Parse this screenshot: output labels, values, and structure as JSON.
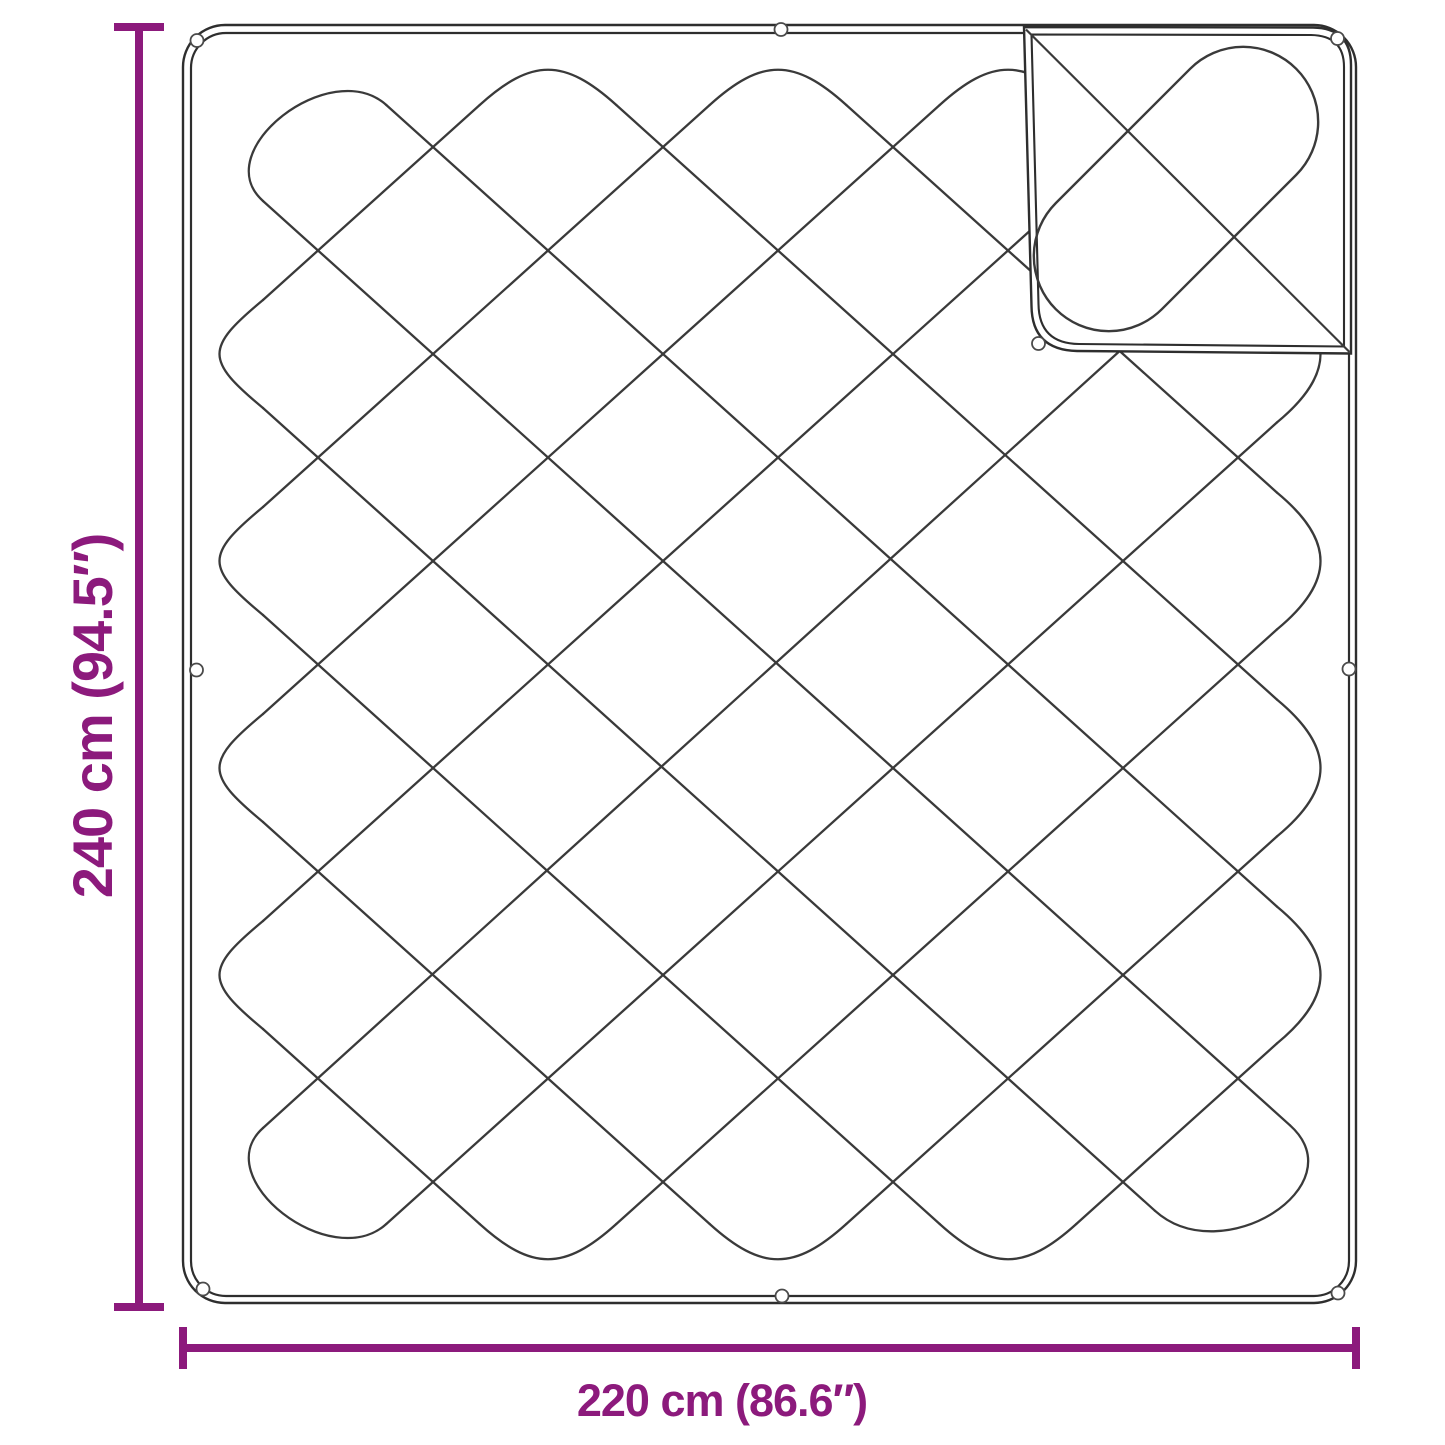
{
  "diagram": {
    "type": "product-dimension-diagram",
    "subject": "quilted blanket with folded corner",
    "dimensions": {
      "height_label": "240 cm (94.5″)",
      "width_label": "220 cm (86.6″)"
    },
    "colors": {
      "dimension": "#8C1A7C",
      "outline": "#2e2e2e",
      "stitch": "#3a3a3a",
      "loop_stroke": "#4a4a4a",
      "background": "#ffffff"
    }
  }
}
